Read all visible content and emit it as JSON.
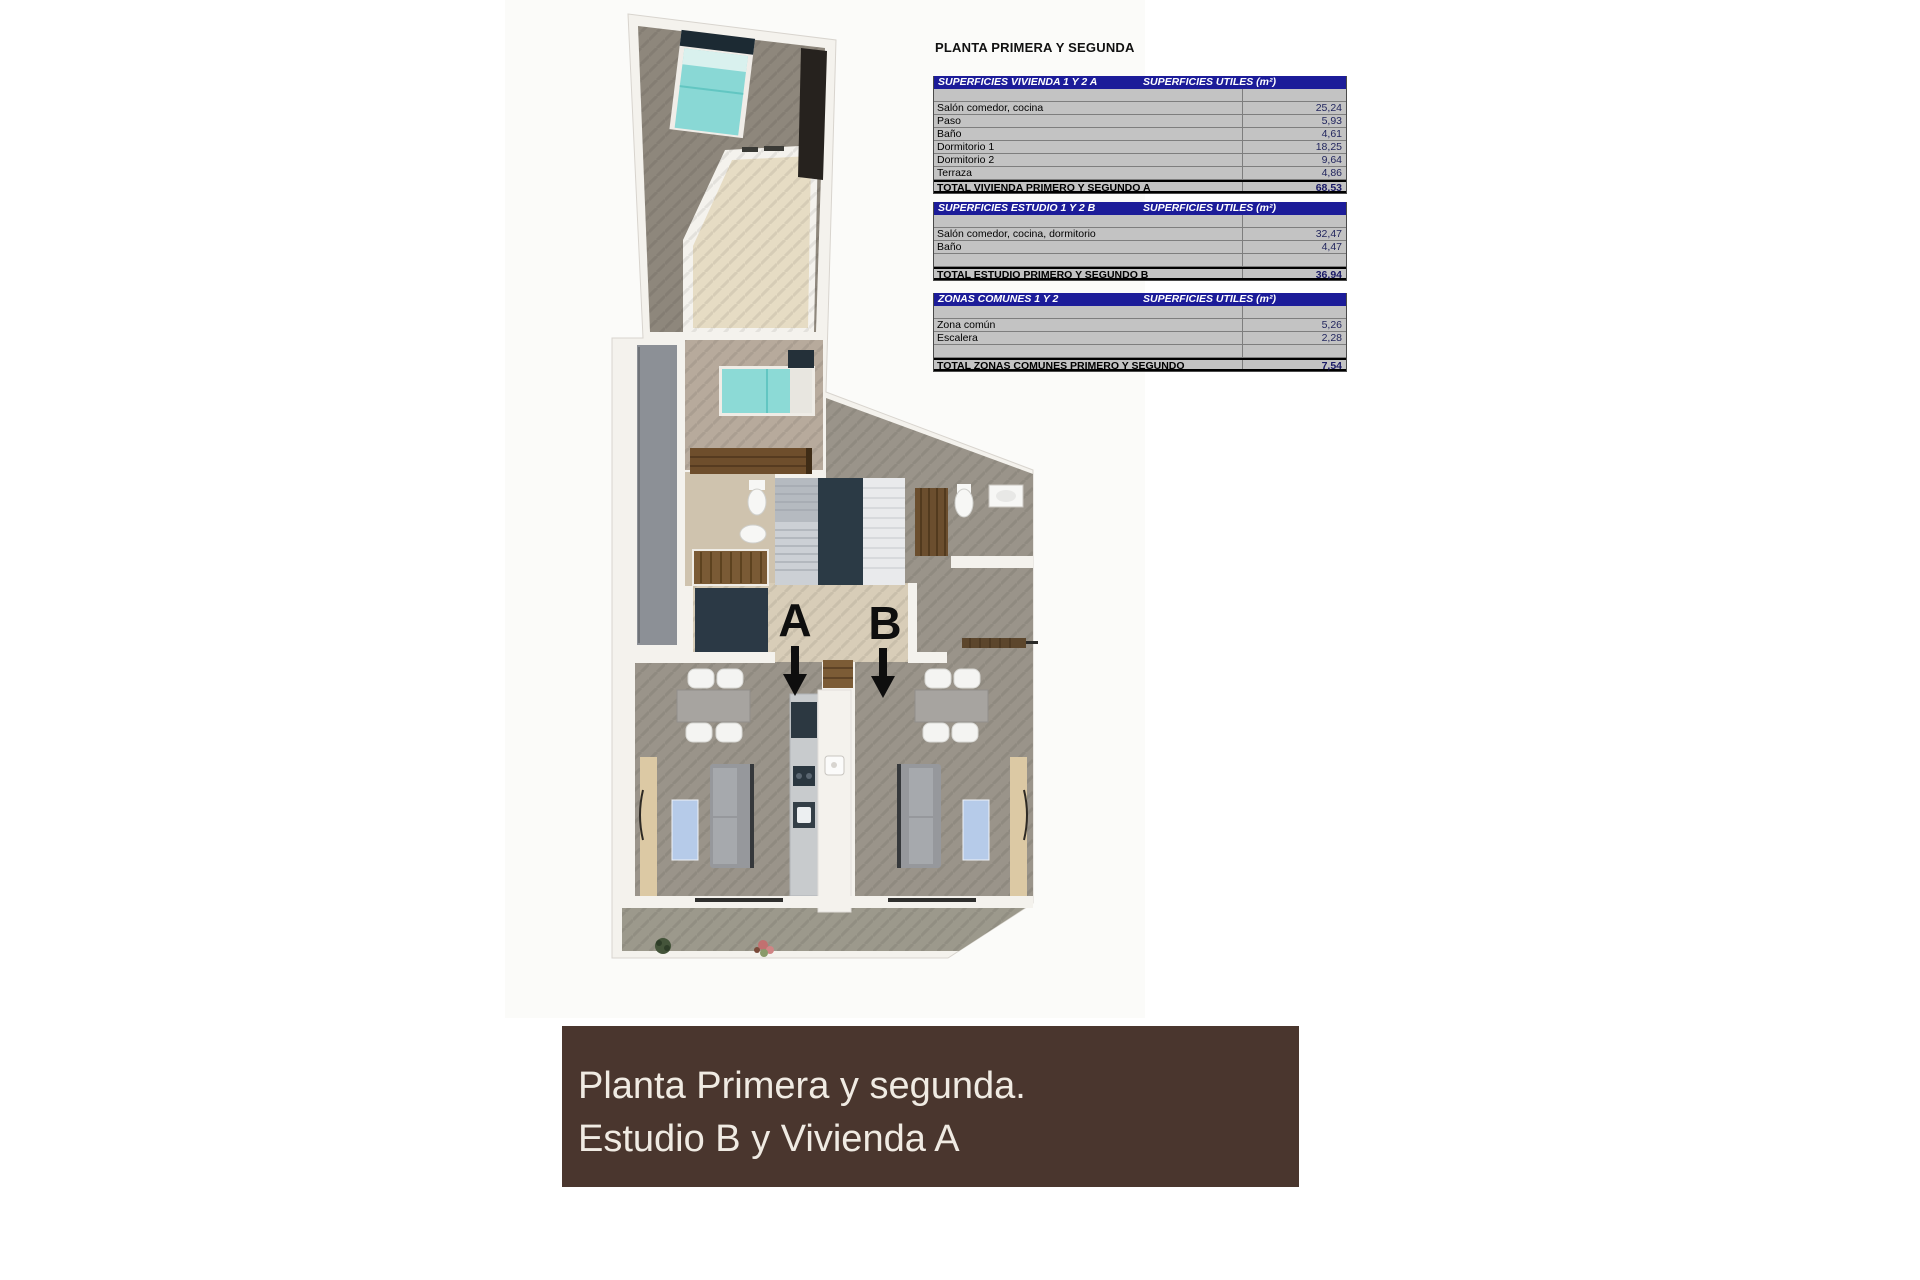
{
  "tables_panel": {
    "title": "PLANTA PRIMERA Y SEGUNDA",
    "value_header": "SUPERFICIES UTILES  (m²)",
    "accent_color": "#1c1c99",
    "tables": [
      {
        "header": "SUPERFICIES VIVIENDA 1 Y 2 A",
        "rows": [
          {
            "label": "",
            "value": ""
          },
          {
            "label": "Salón comedor, cocina",
            "value": "25,24"
          },
          {
            "label": "Paso",
            "value": "5,93"
          },
          {
            "label": "Baño",
            "value": "4,61"
          },
          {
            "label": "Dormitorio 1",
            "value": "18,25"
          },
          {
            "label": "Dormitorio 2",
            "value": "9,64"
          },
          {
            "label": "Terraza",
            "value": "4,86"
          }
        ],
        "total_label": "TOTAL VIVIENDA PRIMERO Y SEGUNDO A",
        "total_value": "68,53"
      },
      {
        "header": "SUPERFICIES ESTUDIO 1 Y 2 B",
        "rows": [
          {
            "label": "",
            "value": ""
          },
          {
            "label": "Salón comedor, cocina, dormitorio",
            "value": "32,47"
          },
          {
            "label": "Baño",
            "value": "4,47"
          },
          {
            "label": "",
            "value": ""
          }
        ],
        "total_label": "TOTAL ESTUDIO PRIMERO Y SEGUNDO B",
        "total_value": "36,94"
      },
      {
        "header": "ZONAS COMUNES 1 Y 2",
        "rows": [
          {
            "label": "",
            "value": ""
          },
          {
            "label": "Zona común",
            "value": "5,26"
          },
          {
            "label": "Escalera",
            "value": "2,28"
          },
          {
            "label": "",
            "value": ""
          }
        ],
        "total_label": "TOTAL ZONAS COMUNES PRIMERO Y SEGUNDO",
        "total_value": "7,54"
      }
    ]
  },
  "plan": {
    "unit_labels": [
      "A",
      "B"
    ],
    "colors": {
      "floor_grey": "#9a948a",
      "floor_beige": "#d8cdb8",
      "bed_teal": "#8cdad6",
      "rug_blue": "#b6cbe9",
      "wood": "#7a5a35",
      "dark_navy": "#2b3945",
      "wall": "#f4f2ed"
    }
  },
  "caption": {
    "line1": "Planta Primera y segunda.",
    "line2": "Estudio B y Vivienda A",
    "background": "#4a362e",
    "text_color": "#f0ebe3"
  }
}
